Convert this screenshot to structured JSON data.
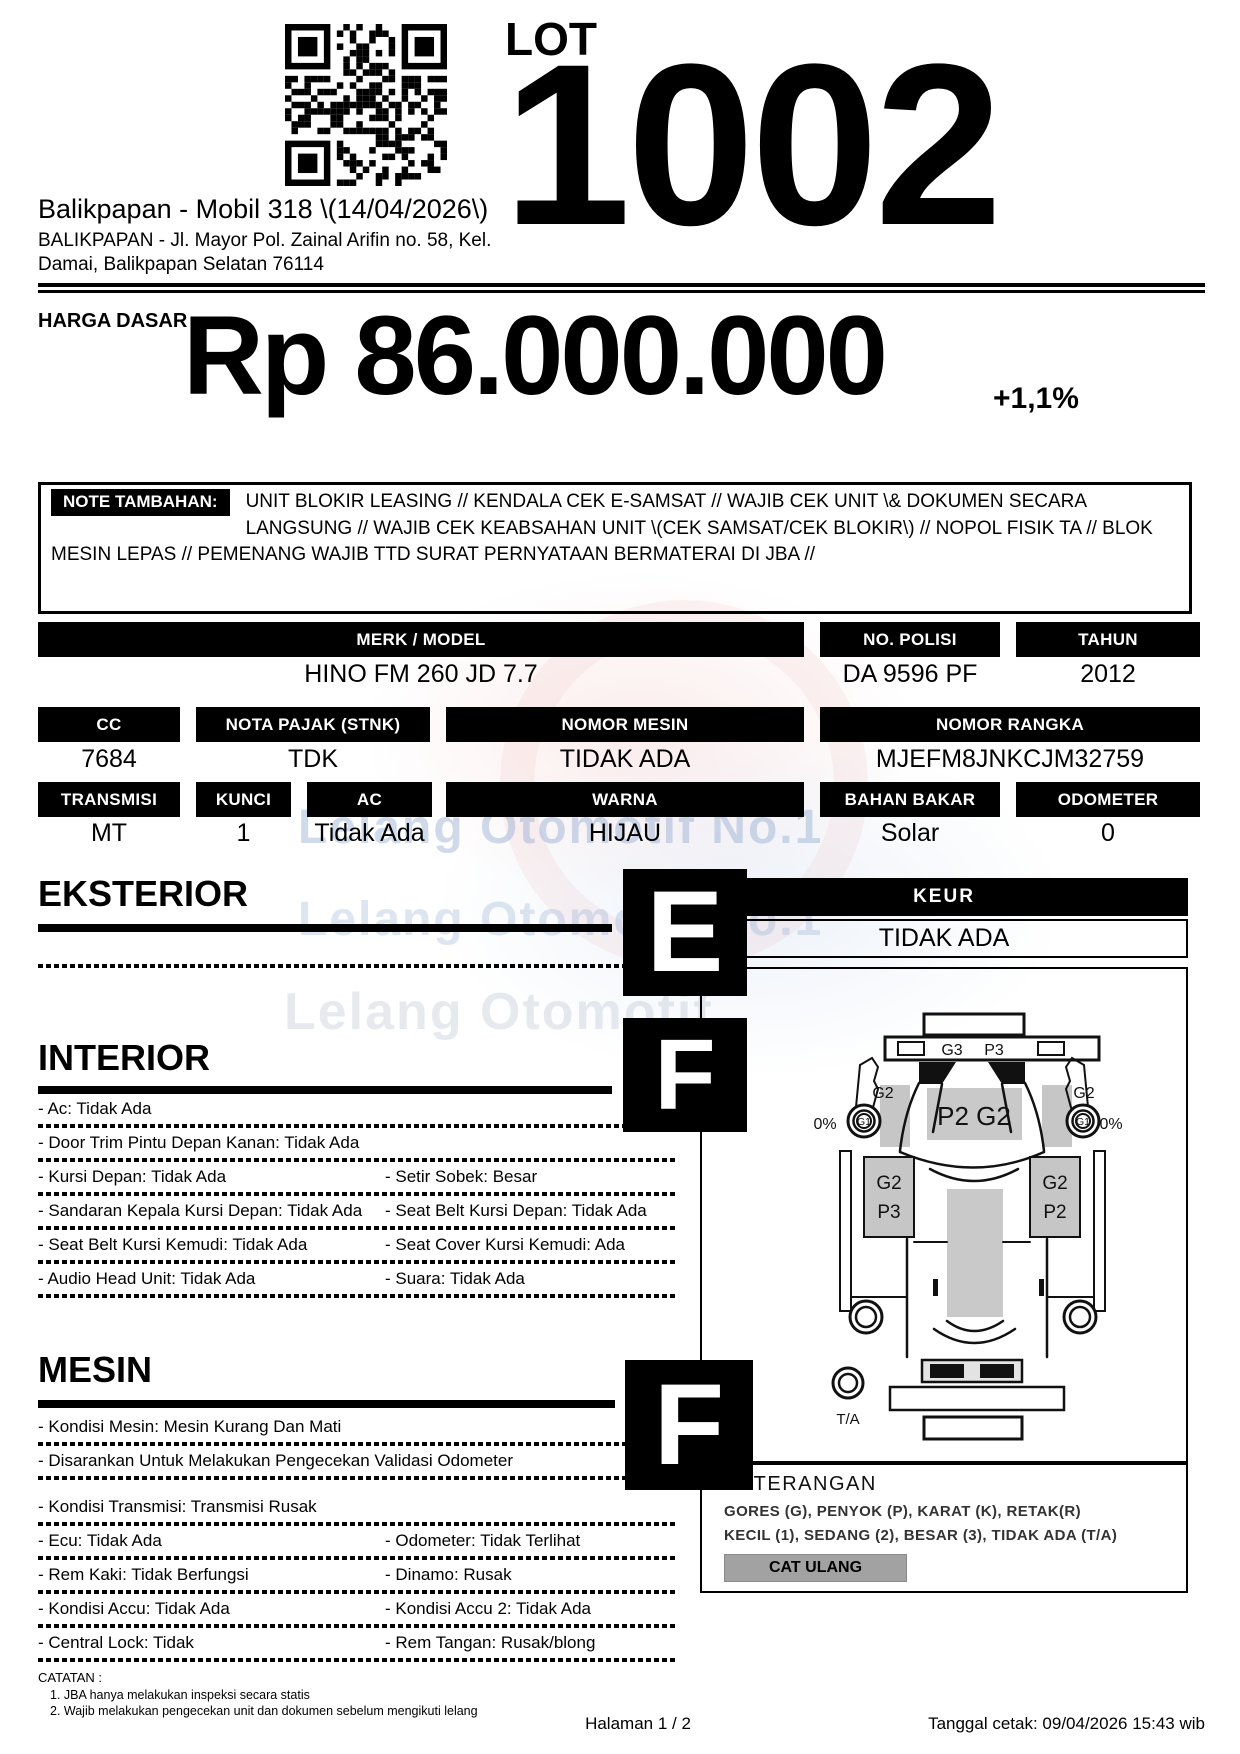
{
  "header": {
    "lot_label": "LOT",
    "lot_number": "1002",
    "auction_title": "Balikpapan - Mobil 318 \\(14/04/2026\\)",
    "address_line1": "BALIKPAPAN - Jl. Mayor Pol. Zainal Arifin no. 58, Kel.",
    "address_line2": "Damai, Balikpapan Selatan 76114"
  },
  "price": {
    "label": "HARGA DASAR :",
    "value": "Rp 86.000.000",
    "increment": "+1,1%"
  },
  "note": {
    "label": "NOTE TAMBAHAN:",
    "text": "UNIT BLOKIR LEASING // KENDALA CEK E-SAMSAT // WAJIB CEK UNIT \\& DOKUMEN SECARA LANGSUNG // WAJIB CEK KEABSAHAN UNIT \\(CEK SAMSAT/CEK BLOKIR\\) // NOPOL FISIK TA // BLOK MESIN LEPAS // PEMENANG WAJIB TTD SURAT PERNYATAAN BERMATERAI DI JBA //"
  },
  "specs": {
    "merk_model": {
      "label": "MERK / MODEL",
      "value": "HINO FM 260 JD 7.7"
    },
    "no_polisi": {
      "label": "NO. POLISI",
      "value": "DA 9596 PF"
    },
    "tahun": {
      "label": "TAHUN",
      "value": "2012"
    },
    "cc": {
      "label": "CC",
      "value": "7684"
    },
    "nota_pajak": {
      "label": "NOTA PAJAK (STNK)",
      "value": "TDK"
    },
    "nomor_mesin": {
      "label": "NOMOR MESIN",
      "value": "TIDAK ADA"
    },
    "nomor_rangka": {
      "label": "NOMOR RANGKA",
      "value": "MJEFM8JNKCJM32759"
    },
    "transmisi": {
      "label": "TRANSMISI",
      "value": "MT"
    },
    "kunci": {
      "label": "KUNCI",
      "value": "1"
    },
    "ac": {
      "label": "AC",
      "value": "Tidak Ada"
    },
    "warna": {
      "label": "WARNA",
      "value": "HIJAU"
    },
    "bahan_bakar": {
      "label": "BAHAN BAKAR",
      "value": "Solar"
    },
    "odometer": {
      "label": "ODOMETER",
      "value": "0"
    }
  },
  "keur": {
    "label": "KEUR",
    "value": "TIDAK ADA"
  },
  "sections": {
    "eksterior": {
      "title": "EKSTERIOR",
      "grade": "E",
      "items": [
        {
          "c1": "",
          "c2": ""
        }
      ]
    },
    "interior": {
      "title": "INTERIOR",
      "grade": "F",
      "items": [
        {
          "c1": "- Ac: Tidak Ada",
          "c2": ""
        },
        {
          "c1": "- Door Trim Pintu Depan Kanan: Tidak Ada",
          "c2": ""
        },
        {
          "c1": "- Kursi Depan: Tidak Ada",
          "c2": "- Setir Sobek: Besar"
        },
        {
          "c1": "- Sandaran Kepala Kursi Depan: Tidak Ada",
          "c2": "- Seat Belt Kursi Depan: Tidak Ada"
        },
        {
          "c1": "- Seat Belt Kursi Kemudi: Tidak Ada",
          "c2": "- Seat Cover Kursi Kemudi: Ada"
        },
        {
          "c1": "- Audio Head Unit: Tidak Ada",
          "c2": "- Suara: Tidak Ada"
        }
      ]
    },
    "mesin": {
      "title": "MESIN",
      "grade": "F",
      "items": [
        {
          "c1": "- Kondisi Mesin: Mesin Kurang Dan Mati",
          "c2": ""
        },
        {
          "c1": "- Disarankan Untuk Melakukan Pengecekan Validasi Odometer",
          "c2": ""
        },
        {
          "c1": "- Kondisi Transmisi: Transmisi Rusak",
          "c2": ""
        },
        {
          "c1": "- Ecu: Tidak Ada",
          "c2": "- Odometer: Tidak Terlihat"
        },
        {
          "c1": "- Rem Kaki: Tidak Berfungsi",
          "c2": "- Dinamo: Rusak"
        },
        {
          "c1": "- Kondisi Accu: Tidak Ada",
          "c2": "- Kondisi Accu 2: Tidak Ada"
        },
        {
          "c1": "- Central Lock: Tidak",
          "c2": "- Rem Tangan: Rusak/blong"
        }
      ]
    }
  },
  "diagram": {
    "labels": {
      "front_bar_left": "G3",
      "front_bar_right": "P3",
      "cab": "P2 G2",
      "mirror_left": "G2",
      "mirror_right": "G2",
      "wheel_left": "G1",
      "wheel_right": "G1",
      "percent_left": "0%",
      "percent_right": "0%",
      "door_left_top": "G2",
      "door_left_bottom": "P3",
      "door_right_top": "G2",
      "door_right_bottom": "P2",
      "spare": "T/A"
    }
  },
  "keterangan": {
    "title": "KETERANGAN",
    "line1": "GORES (G), PENYOK (P), KARAT (K), RETAK(R)",
    "line2": "KECIL (1), SEDANG (2), BESAR (3), TIDAK ADA (T/A)",
    "button": "CAT ULANG"
  },
  "watermark": {
    "line1": "Lelang Otomotif No.1",
    "line2": "Lelang Otomotif No.1",
    "line3": "Lelang Otomotif"
  },
  "footer": {
    "catatan_label": "CATATAN :",
    "catatan_item1": "1. JBA hanya melakukan inspeksi secara statis",
    "catatan_item2": "2. Wajib melakukan pengecekan unit dan dokumen sebelum mengikuti lelang",
    "page": "Halaman 1 / 2",
    "printed": "Tanggal cetak: 09/04/2026 15:43 wib"
  },
  "colors": {
    "bar_bg": "#000000",
    "button_bg": "#a2a2a2",
    "watermark_blue": "#8da8d0",
    "watermark_pink": "#eeaaaa",
    "diagram_gray": "#c6c6c6"
  }
}
